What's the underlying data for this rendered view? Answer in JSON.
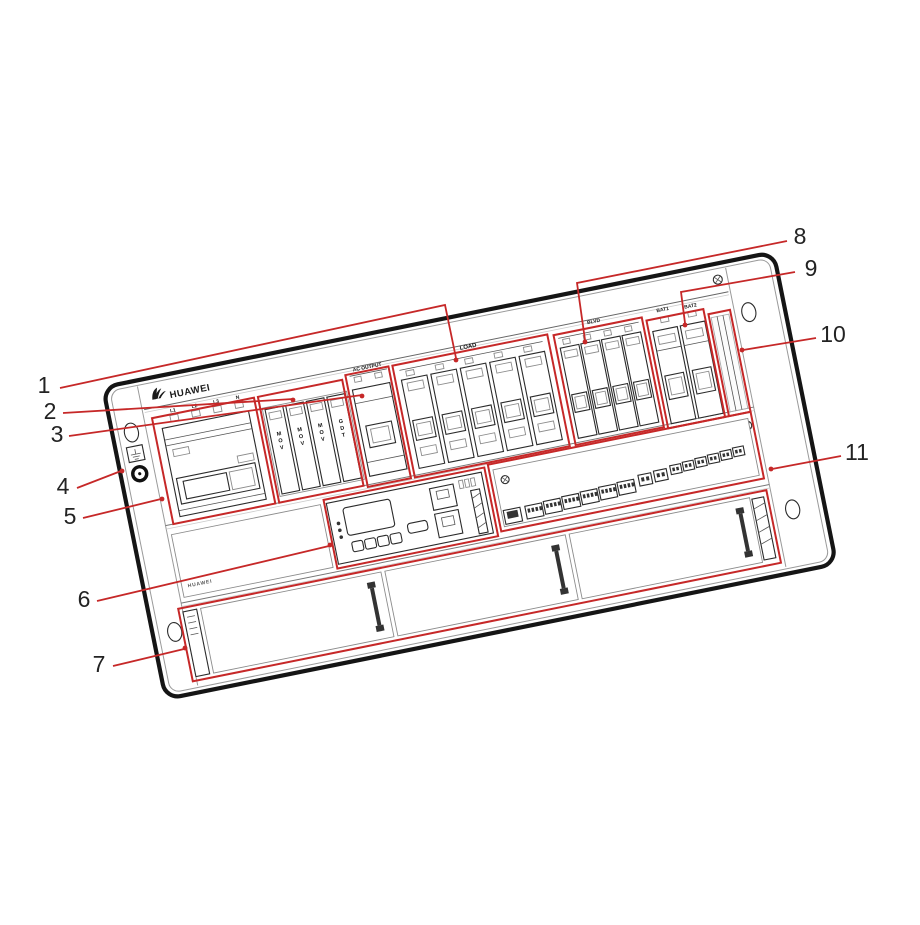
{
  "colors": {
    "callout_red": "#C62828",
    "outline_black": "#151515",
    "detail_gray": "#555555"
  },
  "panel": {
    "brand": "HUAWEI",
    "brand_small": "HUAWEI",
    "load_label": "LOAD",
    "blvd_label": "BLVD",
    "bat1_label": "BAT1",
    "bat2_label": "BAT2",
    "ac_output_label": "AC OUTPUT",
    "phases": [
      "L1",
      "L2",
      "L3",
      "N"
    ],
    "spd_modules": [
      "MOV",
      "MOV",
      "MOV",
      "GDT"
    ]
  },
  "callouts": [
    {
      "num": "1",
      "target": "load-breaker-group"
    },
    {
      "num": "2",
      "target": "surge-protection-modules"
    },
    {
      "num": "3",
      "target": "ac-output-breaker"
    },
    {
      "num": "4",
      "target": "grounding-button"
    },
    {
      "num": "5",
      "target": "ac-input-breaker"
    },
    {
      "num": "6",
      "target": "monitoring-module-indicators"
    },
    {
      "num": "7",
      "target": "rectifier-slot-label"
    },
    {
      "num": "8",
      "target": "blvd-breaker-group"
    },
    {
      "num": "9",
      "target": "battery-breaker-group"
    },
    {
      "num": "10",
      "target": "reserved-slot"
    },
    {
      "num": "11",
      "target": "signal-terminal-panel"
    }
  ]
}
